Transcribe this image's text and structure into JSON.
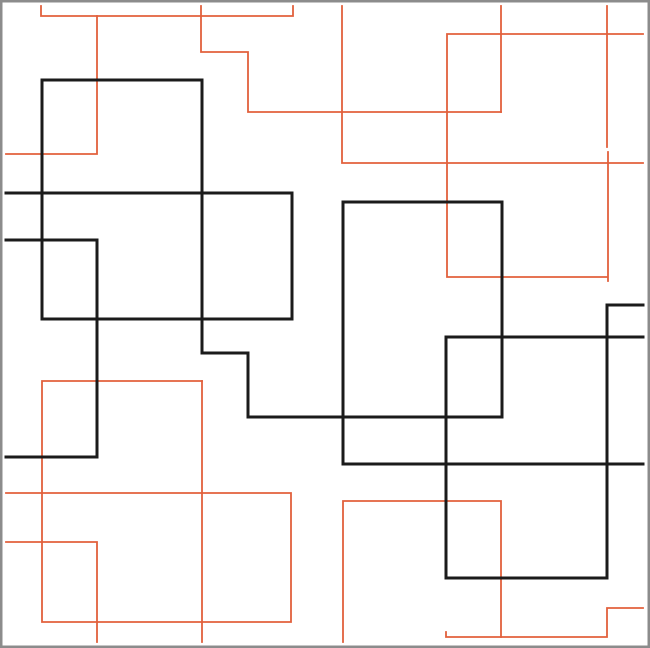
{
  "canvas": {
    "width": 650,
    "height": 648,
    "background_color": "#ffffff",
    "frame_color": "#8c8c8c",
    "frame_width": 2.5
  },
  "colors": {
    "black": "#1b1b1b",
    "orange": "#e2603c"
  },
  "stroke_widths": {
    "black": 3,
    "orange": 1.8
  },
  "paths": [
    {
      "id": "orange-top-bracket",
      "color": "orange",
      "points": [
        [
          41,
          6
        ],
        [
          41,
          16
        ],
        [
          293,
          16
        ],
        [
          293,
          6
        ]
      ]
    },
    {
      "id": "orange-top-left-hook",
      "color": "orange",
      "points": [
        [
          97,
          16
        ],
        [
          97,
          154
        ],
        [
          6,
          154
        ]
      ]
    },
    {
      "id": "orange-top-stair",
      "color": "orange",
      "points": [
        [
          201,
          6
        ],
        [
          201,
          52
        ],
        [
          248,
          52
        ],
        [
          248,
          112
        ],
        [
          501,
          112
        ]
      ]
    },
    {
      "id": "orange-top-mid-vertical",
      "color": "orange",
      "points": [
        [
          501,
          6
        ],
        [
          501,
          112
        ]
      ]
    },
    {
      "id": "orange-mid-tee",
      "color": "orange",
      "points": [
        [
          342,
          6
        ],
        [
          342,
          163
        ],
        [
          643,
          163
        ]
      ]
    },
    {
      "id": "orange-right-ubend",
      "color": "orange",
      "points": [
        [
          643,
          34
        ],
        [
          447,
          34
        ],
        [
          447,
          277
        ],
        [
          607,
          277
        ]
      ]
    },
    {
      "id": "orange-right-vertical-top",
      "color": "orange",
      "points": [
        [
          607,
          6
        ],
        [
          607,
          147
        ]
      ]
    },
    {
      "id": "orange-right-vertical-mid",
      "color": "orange",
      "points": [
        [
          608,
          152
        ],
        [
          608,
          281
        ]
      ]
    },
    {
      "id": "orange-bottomleft-outline",
      "color": "orange",
      "points": [
        [
          202,
          381
        ],
        [
          42,
          381
        ],
        [
          42,
          622
        ],
        [
          291,
          622
        ],
        [
          291,
          493
        ],
        [
          6,
          493
        ]
      ]
    },
    {
      "id": "orange-bottomleft-vertical",
      "color": "orange",
      "points": [
        [
          202,
          381
        ],
        [
          202,
          642
        ]
      ]
    },
    {
      "id": "orange-bottomleft-hook",
      "color": "orange",
      "points": [
        [
          6,
          542
        ],
        [
          97,
          542
        ],
        [
          97,
          642
        ]
      ]
    },
    {
      "id": "orange-bottomright-rect",
      "color": "orange",
      "points": [
        [
          343,
          642
        ],
        [
          343,
          501
        ],
        [
          501,
          501
        ],
        [
          501,
          637
        ]
      ]
    },
    {
      "id": "orange-bottomright-stair",
      "color": "orange",
      "points": [
        [
          446,
          632
        ],
        [
          446,
          637
        ],
        [
          607,
          637
        ],
        [
          607,
          608
        ],
        [
          643,
          608
        ]
      ]
    },
    {
      "id": "black-rect-a-topleft",
      "color": "black",
      "points": [
        [
          42,
          319
        ],
        [
          42,
          80
        ],
        [
          202,
          80
        ]
      ]
    },
    {
      "id": "black-stair-center",
      "color": "black",
      "points": [
        [
          202,
          80
        ],
        [
          202,
          353
        ],
        [
          248,
          353
        ],
        [
          248,
          417
        ],
        [
          501,
          417
        ]
      ]
    },
    {
      "id": "black-rect-a-bottom",
      "color": "black",
      "points": [
        [
          6,
          193
        ],
        [
          292,
          193
        ],
        [
          292,
          319
        ],
        [
          42,
          319
        ]
      ]
    },
    {
      "id": "black-left-cbend",
      "color": "black",
      "points": [
        [
          6,
          240
        ],
        [
          97,
          240
        ],
        [
          97,
          457
        ],
        [
          6,
          457
        ]
      ]
    },
    {
      "id": "black-rect-b",
      "color": "black",
      "points": [
        [
          343,
          464
        ],
        [
          343,
          202
        ],
        [
          502,
          202
        ],
        [
          502,
          417
        ]
      ]
    },
    {
      "id": "black-long-horizontal",
      "color": "black",
      "points": [
        [
          343,
          464
        ],
        [
          643,
          464
        ]
      ]
    },
    {
      "id": "black-rect-d-left",
      "color": "black",
      "points": [
        [
          643,
          337
        ],
        [
          446,
          337
        ],
        [
          446,
          578
        ],
        [
          607,
          578
        ]
      ]
    },
    {
      "id": "black-rect-d-right",
      "color": "black",
      "points": [
        [
          643,
          305
        ],
        [
          607,
          305
        ],
        [
          607,
          578
        ]
      ]
    }
  ]
}
